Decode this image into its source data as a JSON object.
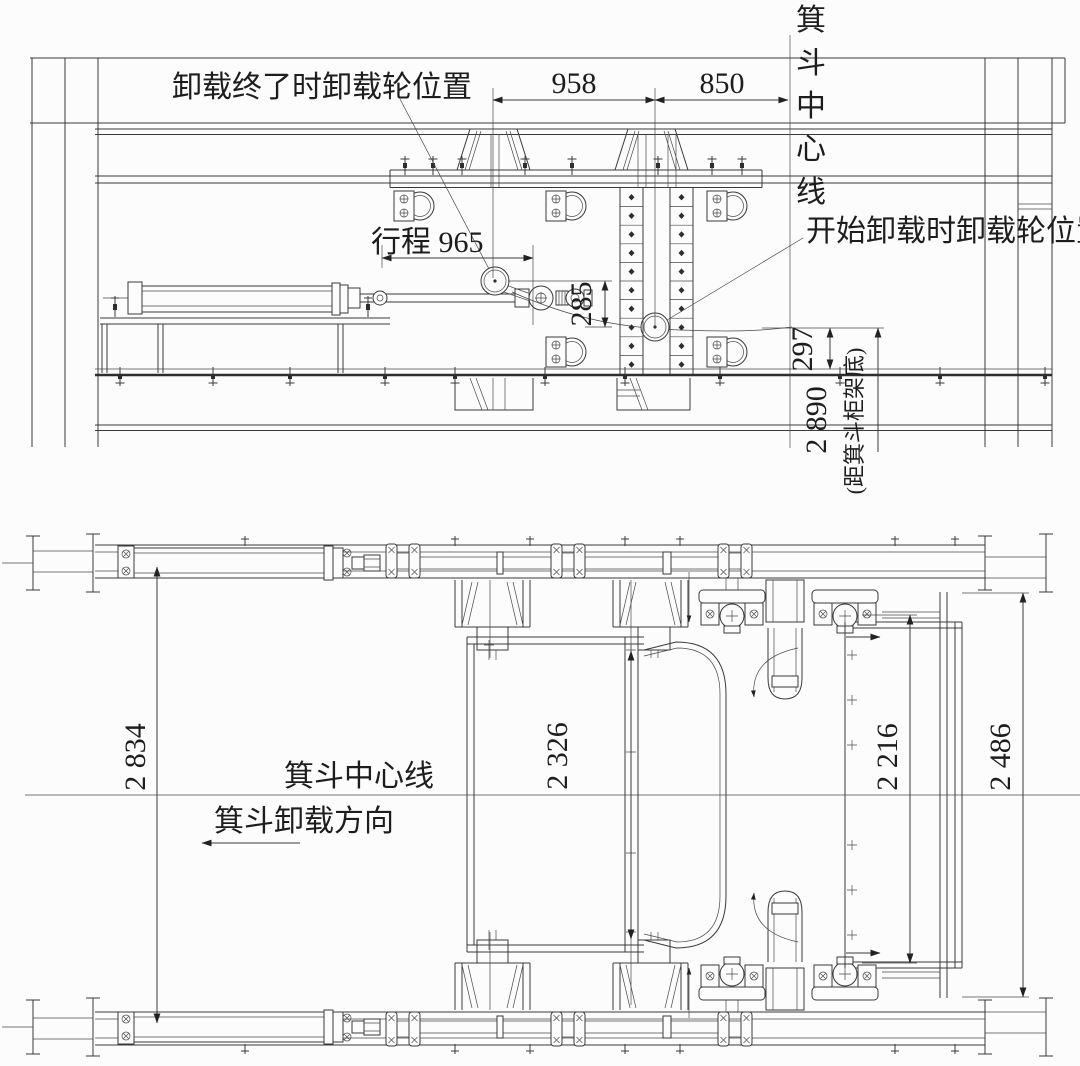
{
  "elevation": {
    "label_end_position": "卸载终了时卸载轮位置",
    "label_start_position": "开始卸载时卸载轮位置",
    "label_skip_centerline_vertical": "箕斗中心线",
    "dim_wheel_travel_h": "958",
    "dim_wheel_to_centerline": "850",
    "dim_stroke": "行程 965",
    "dim_wheel_drop": "285",
    "dim_rail_gap": "297",
    "dim_to_frame_bottom": "2 890",
    "dim_to_frame_bottom_note": "(距箕斗柜架底)"
  },
  "plan": {
    "label_skip_centerline": "箕斗中心线",
    "label_unload_direction": "箕斗卸载方向",
    "dim_rail_span": "2 834",
    "dim_skip_inner": "2 326",
    "dim_frame_height": "2 216",
    "dim_overall_width": "2 486"
  }
}
